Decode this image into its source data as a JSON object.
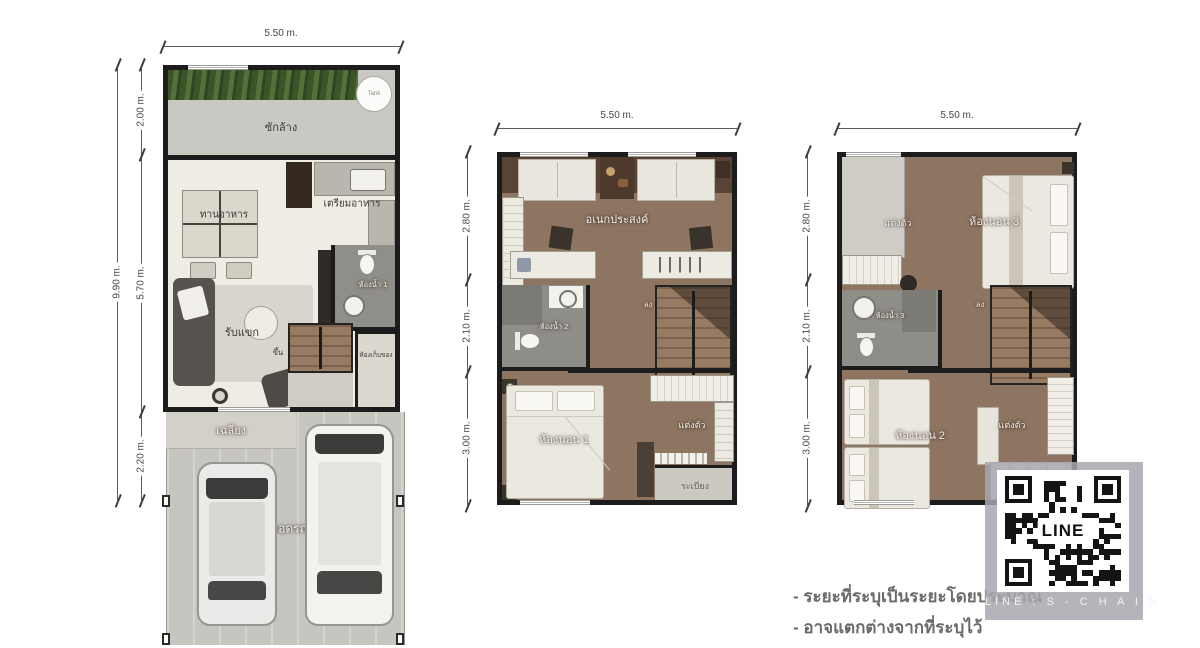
{
  "floor1": {
    "width_dim": "5.50 m.",
    "depth_dim": "9.90 m.",
    "segments": [
      "2.00 m.",
      "5.70 m.",
      "2.20 m."
    ],
    "labels": {
      "laundry": "ซักล้าง",
      "tank": "Tank",
      "dining": "ทานอาหาร",
      "pantry": "เตรียมอาหาร",
      "living": "รับแขก",
      "bathroom": "ห้องน้ำ 1",
      "storage": "ห้องเก็บของ",
      "stair_up": "ขึ้น",
      "porch": "เฉลียง",
      "carport": "จอดรถ"
    }
  },
  "floor2": {
    "width_dim": "5.50 m.",
    "segments": [
      "2.80 m.",
      "2.10 m.",
      "3.00 m."
    ],
    "labels": {
      "multipurpose": "อเนกประสงค์",
      "bathroom": "ห้องน้ำ 2",
      "bedroom1": "ห้องนอน 1",
      "dressing": "แต่งตัว",
      "balcony": "ระเบียง",
      "stair_down": "ลง"
    }
  },
  "floor3": {
    "width_dim": "5.50 m.",
    "segments": [
      "2.80 m.",
      "2.10 m.",
      "3.00 m."
    ],
    "labels": {
      "dressing_top": "แต่งตัว",
      "bedroom3": "ห้องนอน 3",
      "bathroom": "ห้องน้ำ 3",
      "bedroom2": "ห้องนอน 2",
      "dressing_bottom": "แต่งตัว",
      "stair_down": "ลง"
    }
  },
  "watermark": {
    "qr_label": "LINE",
    "caption": "LINE : S - C H A I N"
  },
  "notes": [
    "- ระยะที่ระบุเป็นระยะโดยประมาณ",
    "- อาจแตกต่างจากที่ระบุไว้"
  ],
  "colors": {
    "wall": "#1c1c1c",
    "wood_floor": "#8d7561",
    "cream_floor": "#efece3",
    "concrete": "#c6c5c0",
    "grass": "#49662f"
  }
}
